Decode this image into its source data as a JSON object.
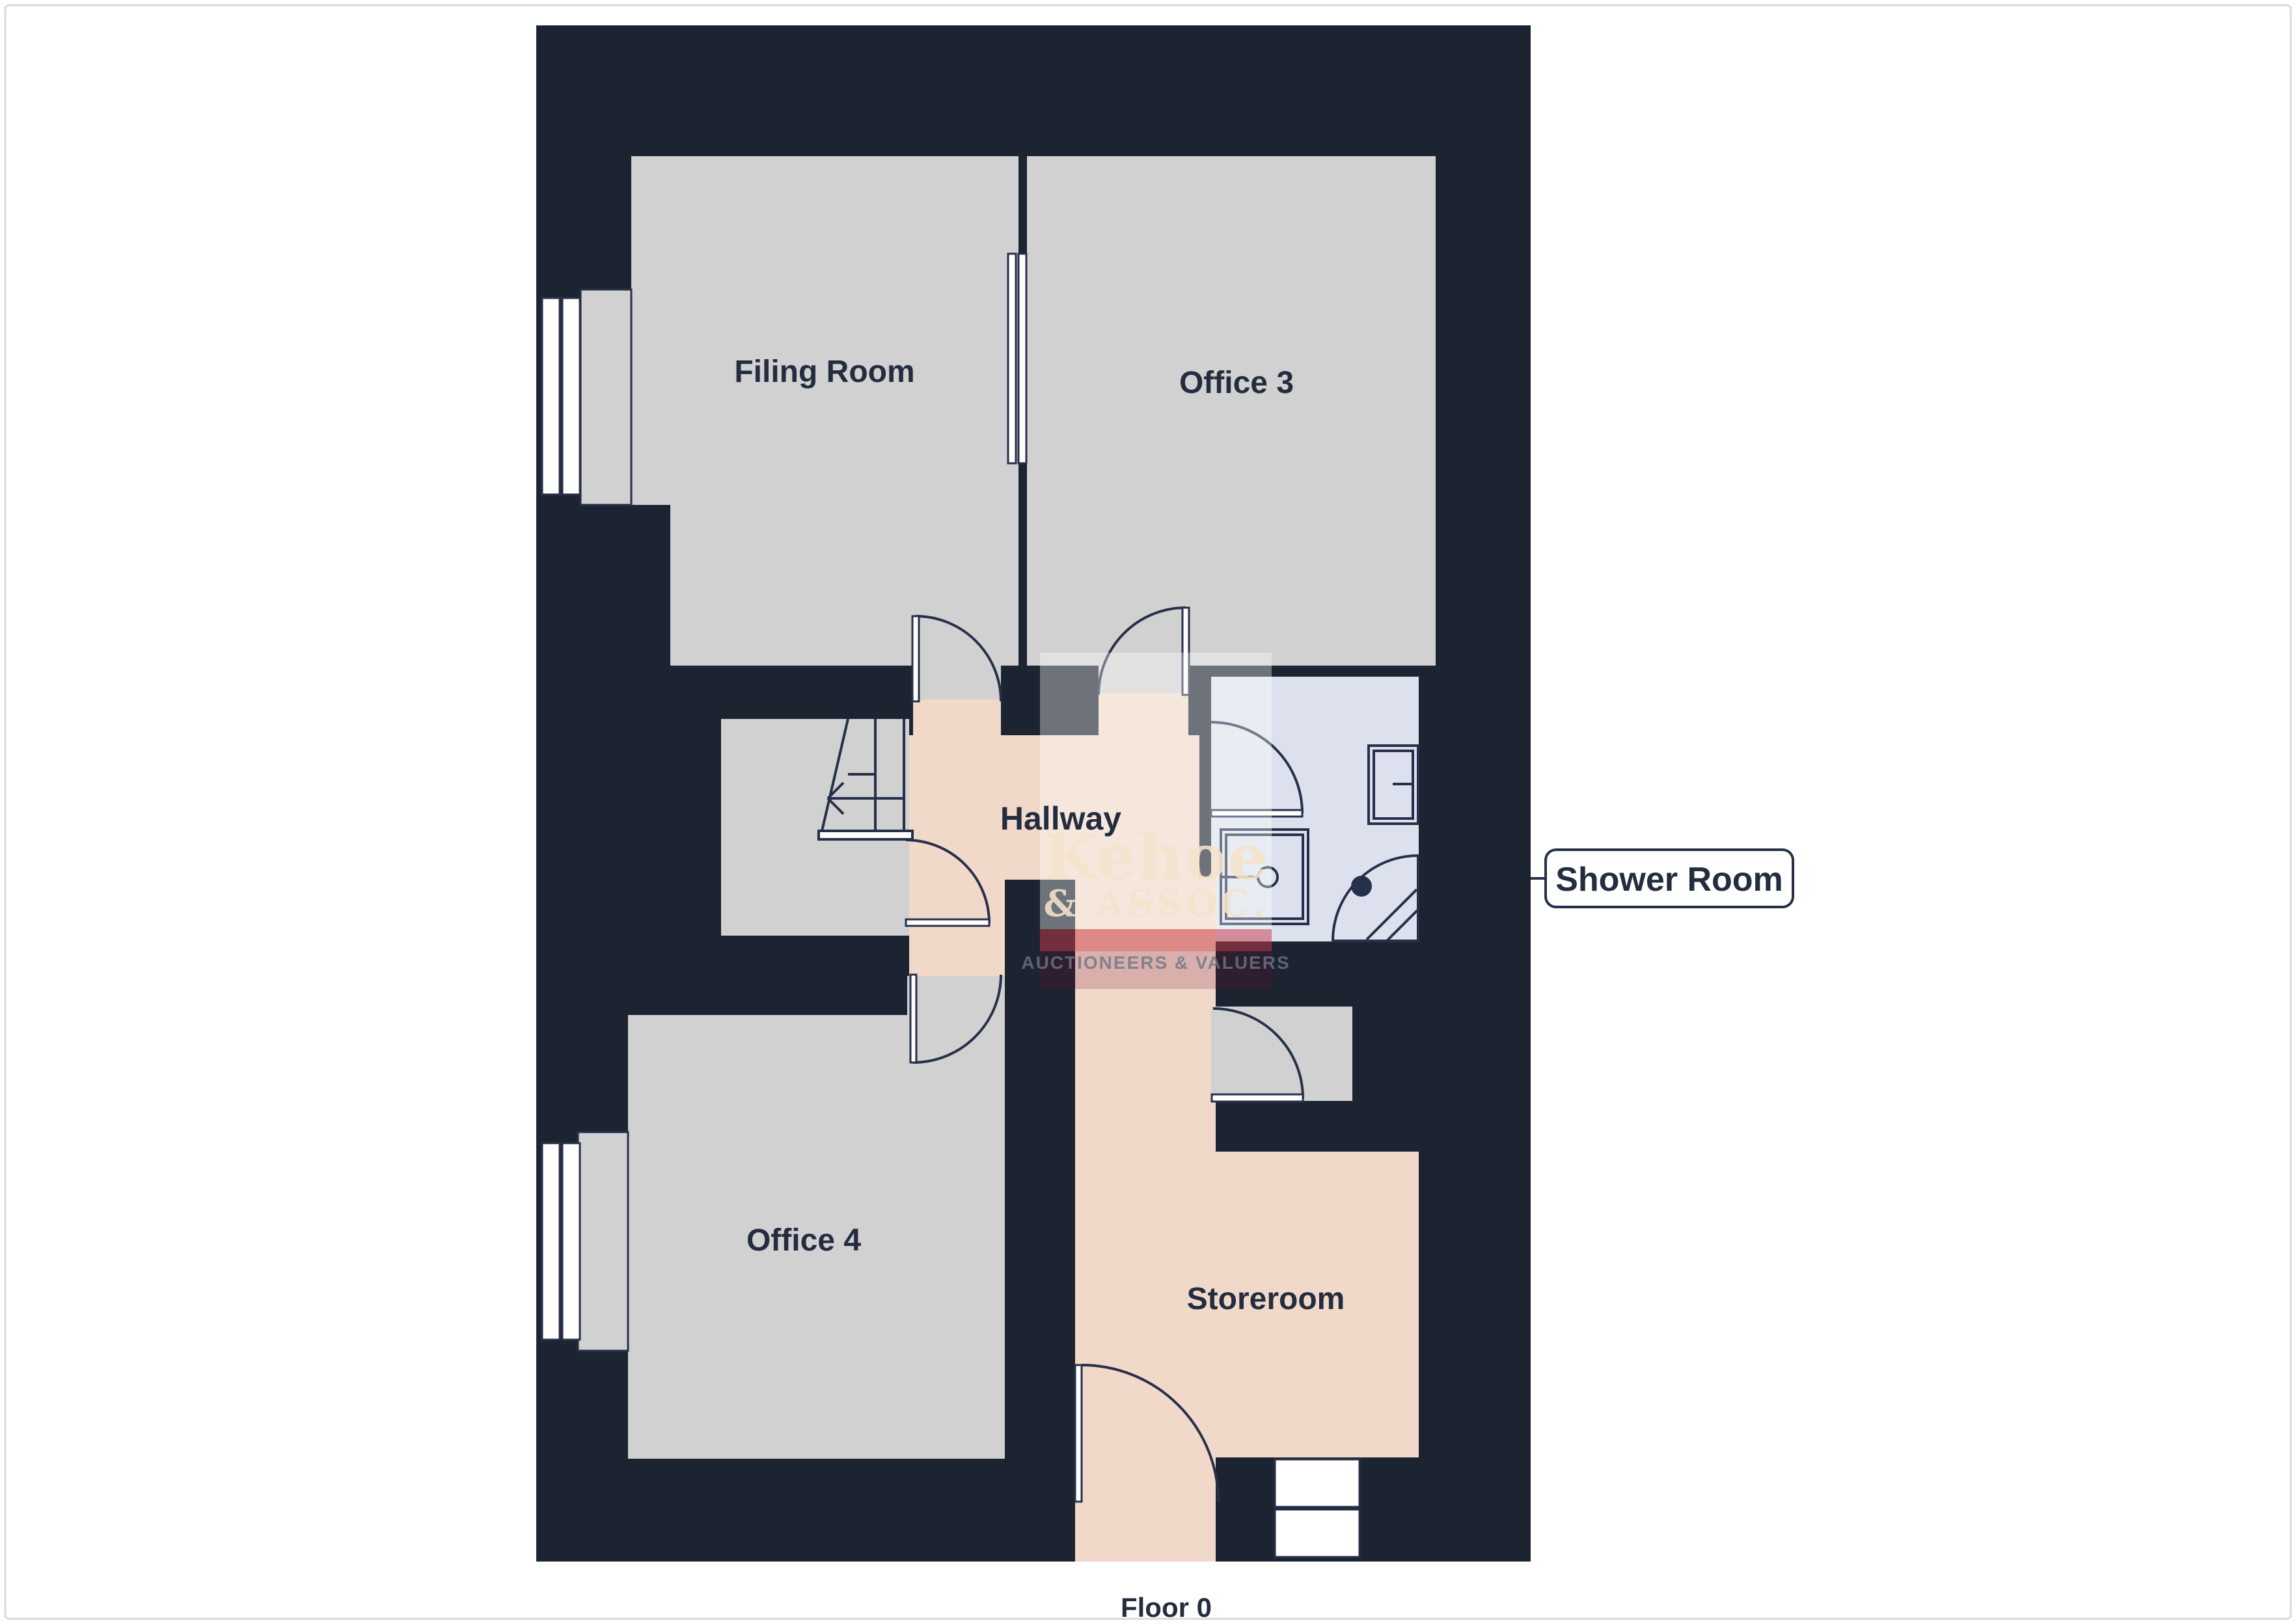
{
  "title": "Floor 0",
  "floor_label": "Floor 0",
  "rooms": {
    "filing": "Filing Room",
    "office3": "Office 3",
    "office4": "Office 4",
    "hallway": "Hallway",
    "storeroom": "Storeroom",
    "shower_callout": "Shower Room"
  },
  "watermark": {
    "line1": "Kehoe",
    "line2": "& ASSOC.",
    "line3": "AUCTIONEERS & VALUERS"
  },
  "icons": {
    "stairs": "stairs-up-arrow-icon",
    "toilet": "toilet-icon",
    "sink": "sink-icon",
    "shower": "corner-shower-icon",
    "doors": "door-swing-arc-icon",
    "windows": "window-pane-icon"
  },
  "colors": {
    "bg": "#ffffff",
    "frame": "#d9dbdd",
    "navy": "#1d2431",
    "gray": "#d1d1d2",
    "peach": "#f1d9ca",
    "shower": "#dce1ed",
    "line": "#27304a",
    "label": "#242d3f",
    "cream": "rgba(244,226,203,0.88)",
    "wmwhite": "rgba(255,255,255,0.36)",
    "wmred": "rgba(201,57,70,0.50)",
    "wmmaroon": "rgba(120,10,45,0.20)",
    "wmgray": "rgba(108,118,138,0.80)"
  }
}
